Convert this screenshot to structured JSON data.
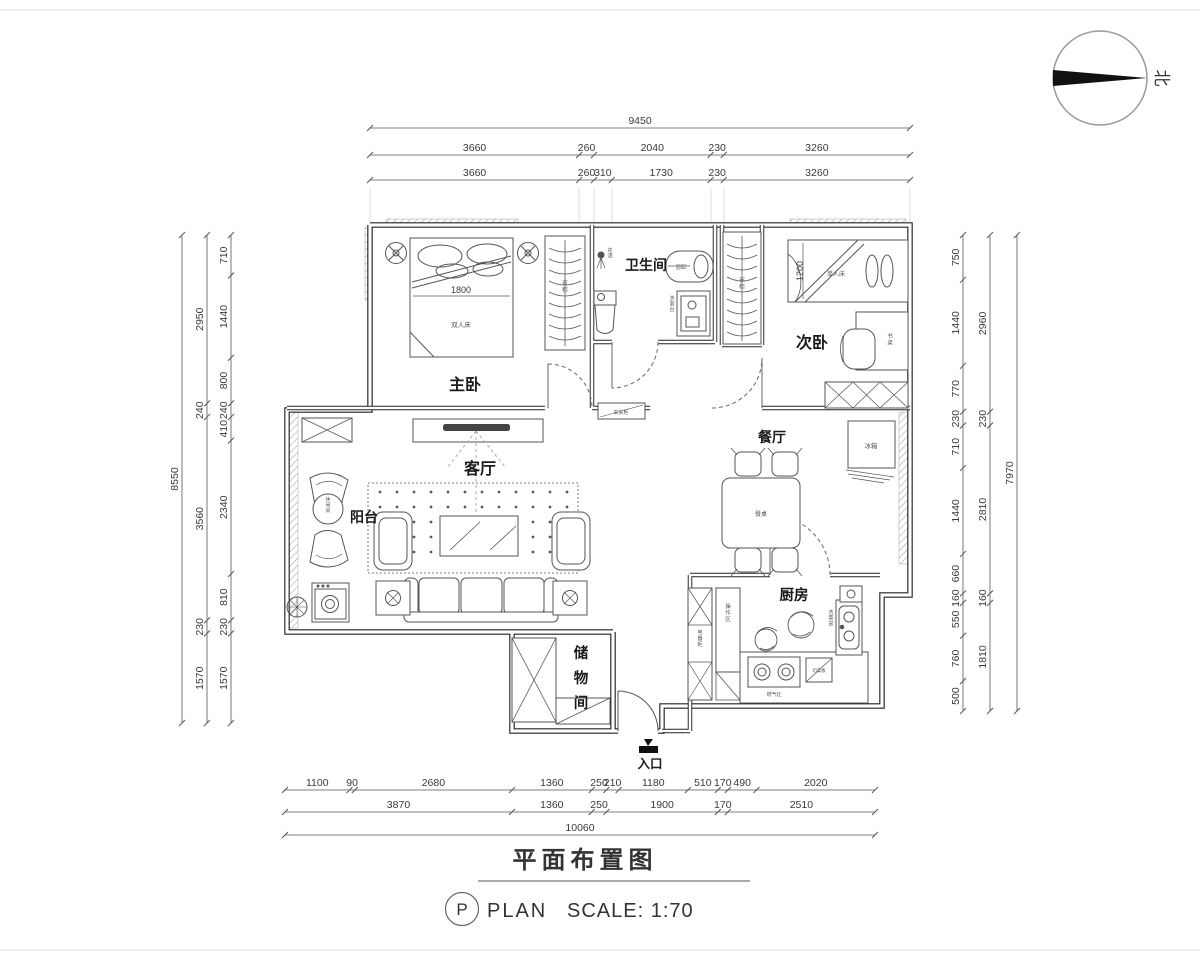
{
  "north": {
    "label": "北"
  },
  "titleblock": {
    "zh": "平面布置图",
    "badge": "P",
    "en": "PLAN",
    "scale": "SCALE: 1:70"
  },
  "rooms": {
    "master": "主卧",
    "bath": "卫生间",
    "second": "次卧",
    "living": "客厅",
    "dining": "餐厅",
    "balcony": "阳台",
    "kitchen": "厨房",
    "storage": "储物间",
    "entrance": "入口"
  },
  "furniture": {
    "double_bed": "双人床",
    "master_bed_width": "1800",
    "single_bed": "单人床",
    "second_bed_width": "1200",
    "wardrobe": "衣柜",
    "closet": "衣柜",
    "shower": "花洒",
    "bathtub": "浴缸",
    "vanity": "洗漱台",
    "desk": "书桌",
    "fridge": "冰箱",
    "dining_table": "餐桌",
    "leisure_table": "休闲桌",
    "cabinet": "电器柜",
    "workzone": "操作区",
    "stove": "燃气灶",
    "board": "切菜板",
    "sink": "洗菜盆",
    "entry_cabinet": "玄关柜"
  },
  "dims": {
    "top": {
      "total": [
        "9450"
      ],
      "mid": [
        "3660",
        "260",
        "2040",
        "230",
        "3260"
      ],
      "inner": [
        "3660",
        "260",
        "310",
        "1730",
        "230",
        "3260"
      ]
    },
    "left": {
      "total": [
        "8550"
      ],
      "mid": [
        "2950",
        "240",
        "3560",
        "230",
        "1570"
      ],
      "inner": [
        "710",
        "1440",
        "800",
        "240",
        "410",
        "2340",
        "810",
        "230",
        "1570"
      ]
    },
    "right": {
      "total": [
        "7970"
      ],
      "mid": [
        "2960",
        "230",
        "2810",
        "160",
        "1810"
      ],
      "inner": [
        "750",
        "1440",
        "770",
        "230",
        "710",
        "1440",
        "660",
        "160",
        "550",
        "760",
        "500"
      ]
    },
    "bottom": {
      "total": [
        "10060"
      ],
      "mid": [
        "3870",
        "1360",
        "250",
        "1900",
        "170",
        "2510"
      ],
      "inner": [
        "1100",
        "90",
        "2680",
        "1360",
        "250",
        "210",
        "1180",
        "510",
        "170",
        "490",
        "2020"
      ]
    }
  }
}
